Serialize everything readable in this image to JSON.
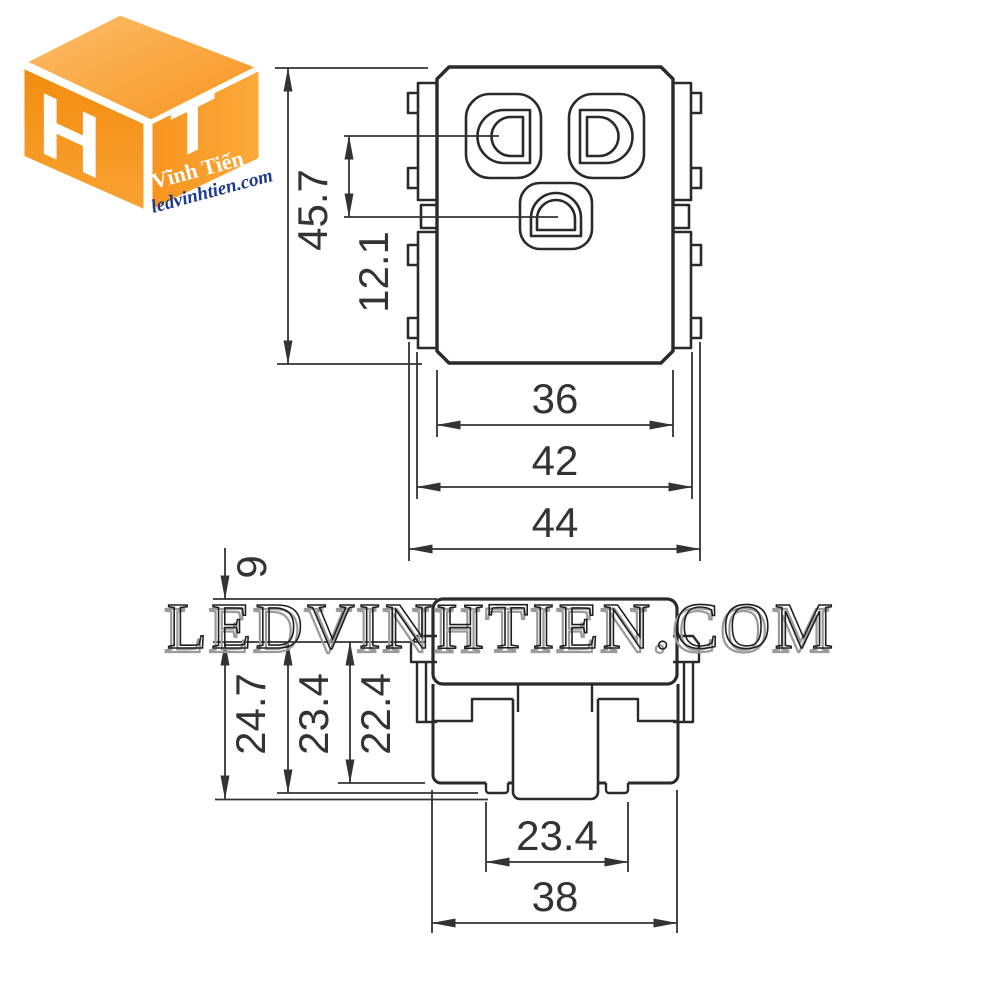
{
  "logo": {
    "letter_left": "H",
    "letter_right": "T",
    "brand": "Vĩnh Tiến",
    "website": "ledvinhtien.com",
    "orange": "#F7941E",
    "orange_light": "#FBB042",
    "blue": "#1E3A8C"
  },
  "watermark": {
    "text": "LEDVINHTIEN.COM"
  },
  "drawing": {
    "line_color": "#2a2a2a",
    "dim_color": "#333333",
    "top_view": {
      "height_total": "45.7",
      "hole_offset": "12.1",
      "width_inner": "36",
      "width_mid": "42",
      "width_outer": "44"
    },
    "side_view": {
      "face_height": "9",
      "depth_max": "24.7",
      "depth_mid": "23.4",
      "depth_body": "22.4",
      "claw_span": "23.4",
      "body_width": "38"
    }
  }
}
